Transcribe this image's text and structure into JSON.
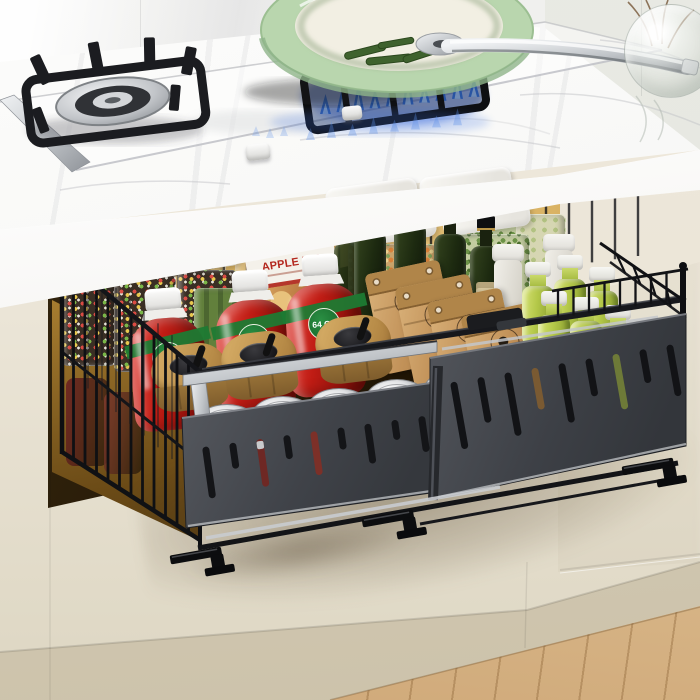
{
  "scene": {
    "type": "kitchen product photograph",
    "subject": "pull-out under-cabinet metal storage basket drawer filled with pantry items, below a marble countertop with a gas stove",
    "labels": {
      "box_title": "APPLE PIE",
      "ketchup_size": "64 OZ"
    },
    "items": {
      "cork_jars": {
        "count": 3,
        "desc": "glass jars with cork lids"
      },
      "pantry_containers": {
        "count": 4,
        "desc": "white-lidded grain containers"
      },
      "sprinkle_jars": {
        "count": 2,
        "desc": "square jars with colorful sprinkles"
      },
      "ketchup_bottles": {
        "count": 3,
        "desc": "red ketchup bottles with white caps"
      },
      "olive_oil_bottles": {
        "count": 4,
        "desc": "dark green oil bottles"
      },
      "supplement_bottles": {
        "count": 2,
        "desc": "white plastic bottles"
      },
      "kraft_bags": {
        "count": 4,
        "desc": "kraft paper pouches"
      },
      "juice_bottles": {
        "count": 6,
        "desc": "green juice bottles with white caps"
      },
      "wood_canisters": {
        "count": 3,
        "desc": "wooden canisters with black lids"
      },
      "metal_tins": {
        "count": 6,
        "desc": "round metal tins, front row"
      }
    },
    "colors": {
      "wall": "#f2f2f0",
      "wall_right": "#e7e8e1",
      "counter": "#fafaf9",
      "marble_vein": "#c6c7cc",
      "fascia": "#f4f3f0",
      "cabinet": "#ece6d8",
      "cabinet_shadow": "#d9d1bd",
      "under_cabinet_glow": "#f2cd82",
      "opening_dark": "#241806",
      "wood_floor": "#d9ba8c",
      "basket_frame": "#141519",
      "front_panel": "#4a4d53",
      "chrome": "#d5d8db",
      "pan_green": "#bcd8b2",
      "pan_interior": "#f2efe3",
      "flame_blue": "#2f6fe2",
      "ketchup_red": "#c01c14",
      "ketchup_band": "#1d7a33",
      "cork": "#c49a5d",
      "kraft": "#c29259",
      "juice_green": "#b3c748",
      "olive_green": "#22300f",
      "wood_canister": "#c09450"
    }
  }
}
